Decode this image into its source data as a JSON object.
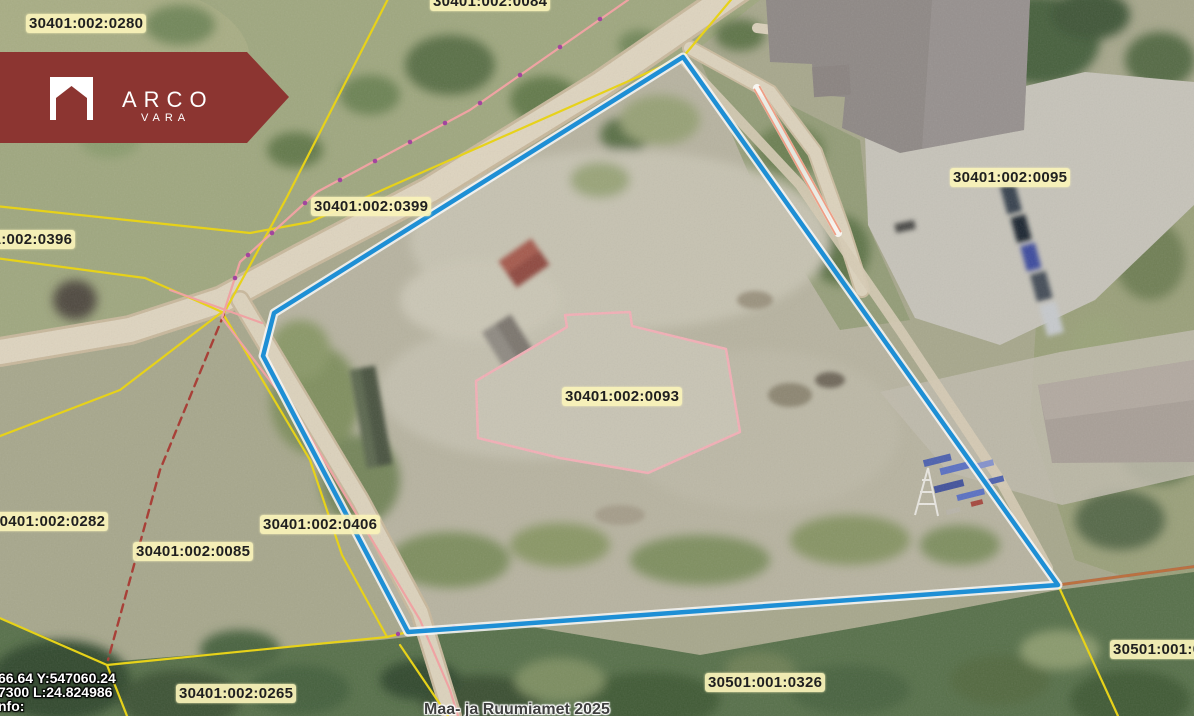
{
  "logo": {
    "brand": "ARCO",
    "sub": "VARA",
    "color": "#8c3531"
  },
  "map": {
    "selection_color": "#1e8fd5",
    "label_background": "#faf3b9",
    "boundary_color": "#e7d219",
    "labels": [
      {
        "id": "parcel-30401-002-0280",
        "text": "30401:002:0280"
      },
      {
        "id": "parcel-30401-002-0084",
        "text": "30401:002:0084"
      },
      {
        "id": "parcel-30401-002-0399",
        "text": "30401:002:0399"
      },
      {
        "id": "parcel-30401-002-0396",
        "text": "30401:002:0396"
      },
      {
        "id": "parcel-30401-002-0095",
        "text": "30401:002:0095"
      },
      {
        "id": "parcel-30401-002-0093",
        "text": "30401:002:0093"
      },
      {
        "id": "parcel-30401-002-0282",
        "text": "30401:002:0282"
      },
      {
        "id": "parcel-30401-002-0085",
        "text": "30401:002:0085"
      },
      {
        "id": "parcel-30401-002-0406",
        "text": "30401:002:0406"
      },
      {
        "id": "parcel-30401-002-0265",
        "text": "30401:002:0265"
      },
      {
        "id": "parcel-30501-001-0326",
        "text": "30501:001:0326"
      },
      {
        "id": "parcel-30501-001-partial",
        "text": "30501:001:0"
      }
    ]
  },
  "overlay": {
    "coords": {
      "line1": "66.64 Y:547060.24",
      "line2": "7300 L:24.824986",
      "line3": "nfo:"
    },
    "attribution": "Maa- ja Ruumiamet 2025"
  }
}
